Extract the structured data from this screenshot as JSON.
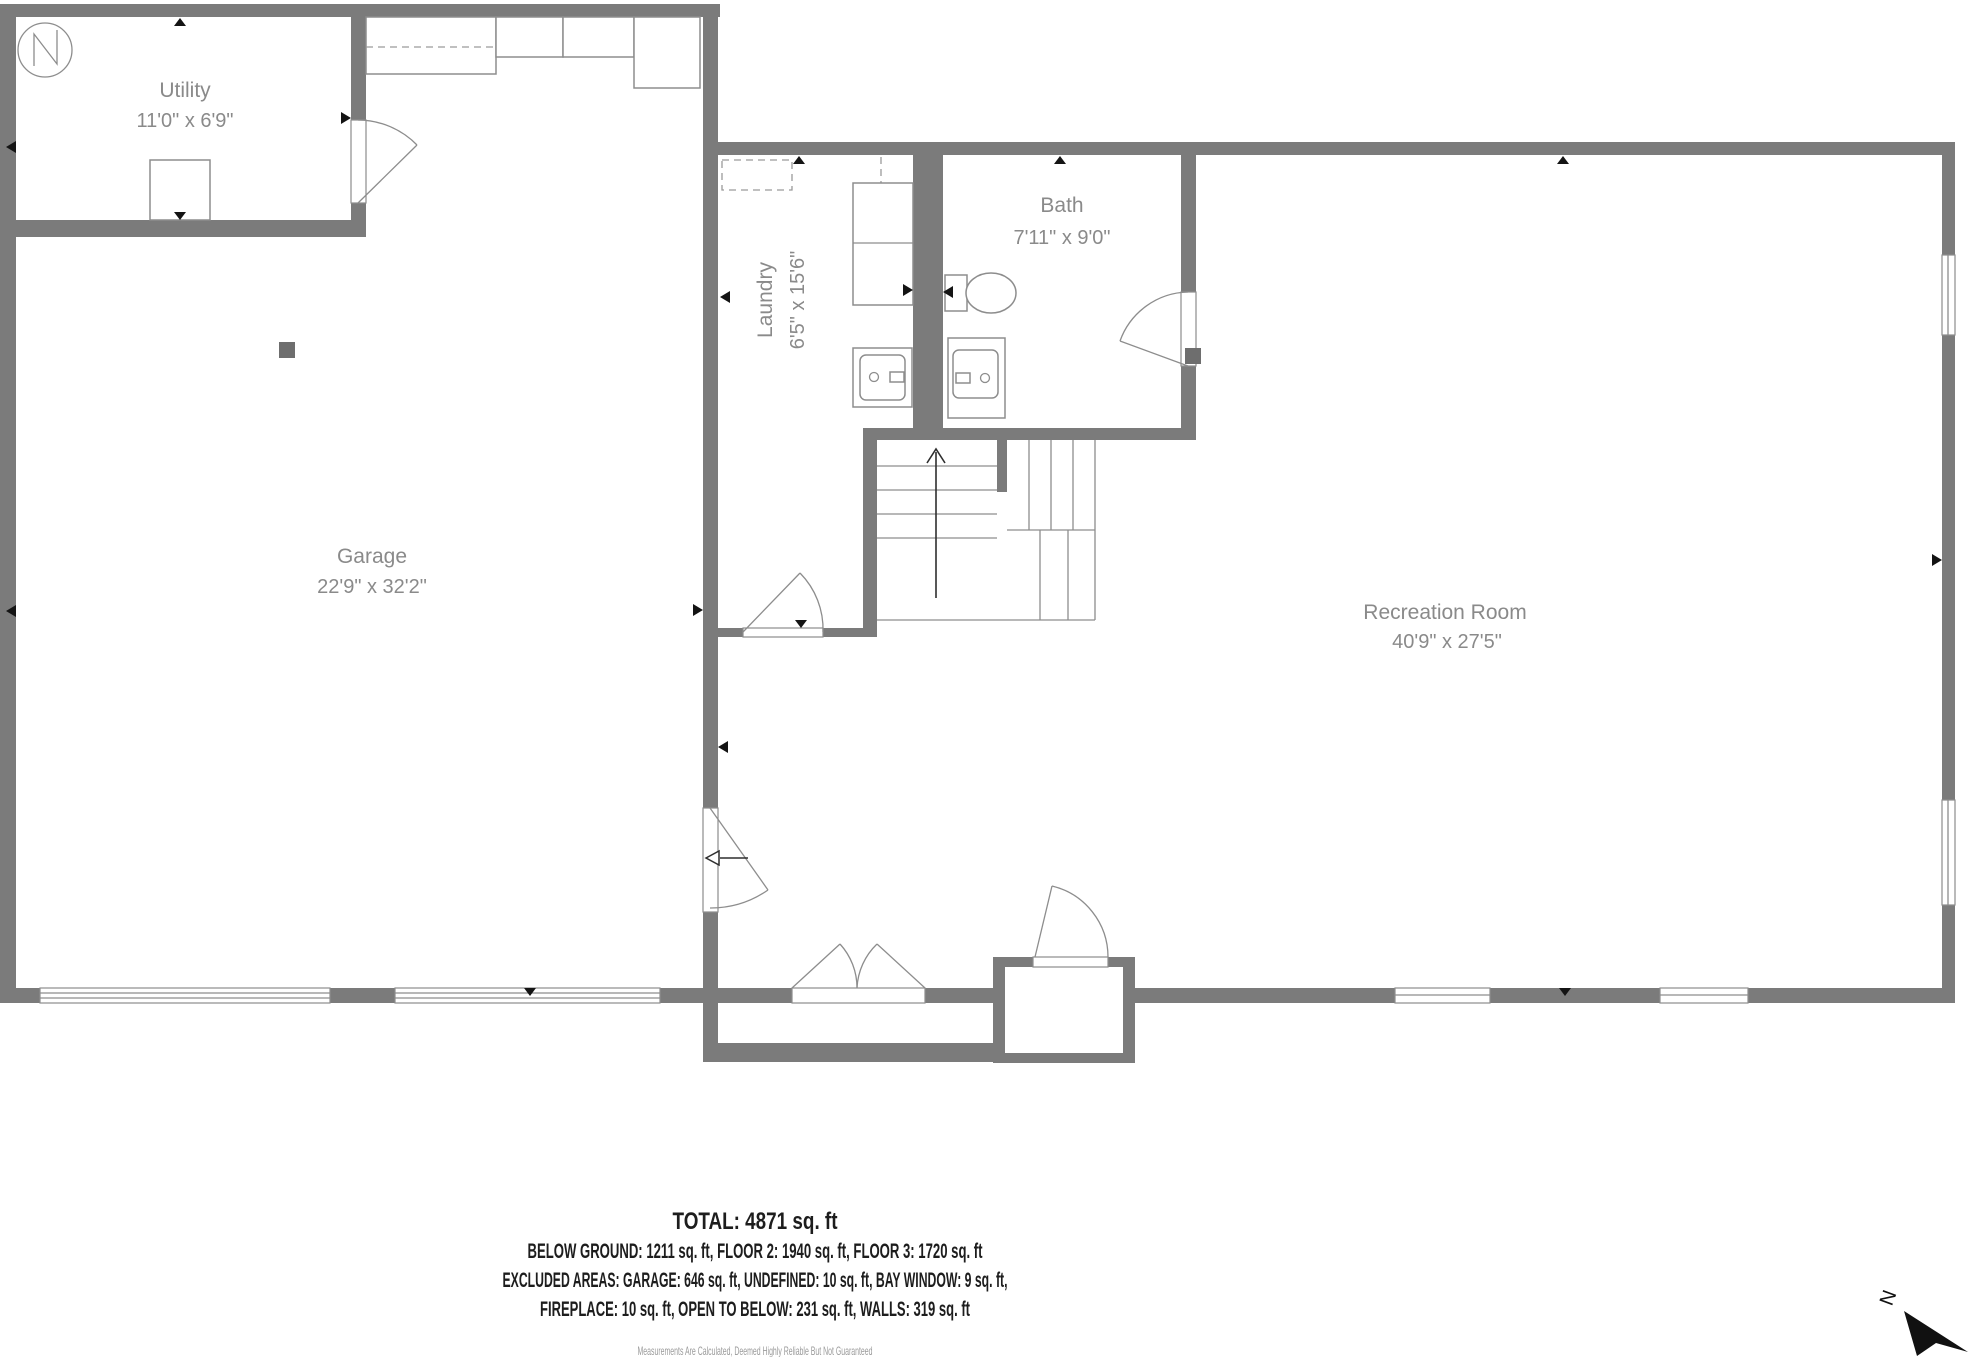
{
  "rooms": {
    "utility": {
      "name": "Utility",
      "dims": "11'0\" x 6'9\""
    },
    "garage": {
      "name": "Garage",
      "dims": "22'9\" x 32'2\""
    },
    "laundry": {
      "name": "Laundry",
      "dims": "6'5\" x 15'6\""
    },
    "bath": {
      "name": "Bath",
      "dims": "7'11\" x 9'0\""
    },
    "recreation": {
      "name": "Recreation Room",
      "dims": "40'9\" x 27'5\""
    }
  },
  "summary": {
    "total": "TOTAL: 4871 sq. ft",
    "line2": "BELOW GROUND: 1211 sq. ft, FLOOR 2: 1940 sq. ft, FLOOR 3: 1720 sq. ft",
    "line3": "EXCLUDED AREAS: GARAGE: 646 sq. ft, UNDEFINED: 10 sq. ft, BAY WINDOW: 9 sq. ft,",
    "line4": "FIREPLACE: 10 sq. ft, OPEN TO BELOW: 231 sq. ft, WALLS: 319 sq. ft",
    "disclaimer": "Measurements Are Calculated, Deemed Highly Reliable But Not Guaranteed"
  },
  "compass": {
    "north_label": "N"
  },
  "colors": {
    "wall": "#7b7b7b",
    "thin_line": "#8d8d8d",
    "room_text": "#8a8a8a",
    "marker": "#141414",
    "summary_text": "#1d1d1d",
    "disclaimer_text": "#9a9a9a"
  }
}
